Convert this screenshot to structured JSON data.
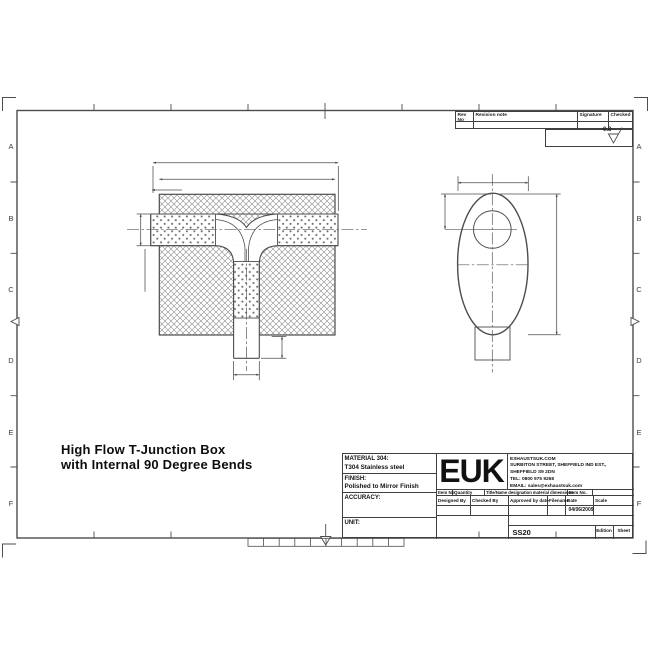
{
  "sheet": {
    "row_labels": [
      "A",
      "B",
      "C",
      "D",
      "E",
      "F"
    ],
    "surface_finish_value": "0.8"
  },
  "revision_table": {
    "col_rev_no": "Rev No",
    "col_revision_note": "Revision note",
    "col_signature": "Signature",
    "col_checked": "Checked"
  },
  "drawing_title": {
    "line1": "High Flow T-Junction Box",
    "line2": "with Internal 90 Degree Bends"
  },
  "title_block": {
    "material_label": "MATERIAL 304:",
    "material_value": "T304 Stainless steel",
    "finish_label": "FINISH:",
    "finish_value": "Polished to Mirror Finish",
    "accuracy_label": "ACCURACY:",
    "unit_label": "UNIT:",
    "logo_text": "EUK",
    "company_line1": "EXHAUSTSUK.COM",
    "company_line2": "SURBITON STREET, SHEFFIELD IND EST.,",
    "company_line3": "SHEFFIELD S9 2DN",
    "company_line4": "TEL: 0800 975 9268",
    "company_line5": "EMAIL: sales@exhaustsuk.com",
    "strip_item_no": "Item No",
    "strip_quantity": "Quantity",
    "strip_title": "Title/Name designation material dimensions",
    "strip_item_no2": "Item No.",
    "designed_by": "Designed By",
    "checked_by": "Checked By",
    "approved_by": "Approved by date",
    "filename_label": "Filename",
    "date_label": "Date",
    "scale_label": "Scale",
    "date_value": "04/06/2009",
    "drawing_number": "SS20",
    "edition_label": "Edition",
    "sheet_label": "Sheet"
  }
}
